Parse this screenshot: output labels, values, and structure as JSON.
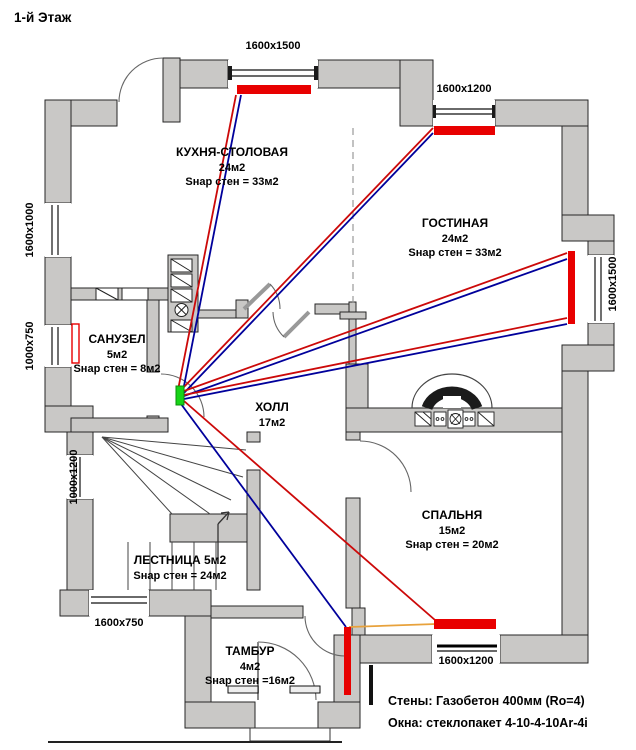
{
  "title": "1-й Этаж",
  "notes": {
    "walls": "Стены: Газобетон 400мм (Ro=4)",
    "windows": "Окна: стеклопакет 4-10-4-10Ar-4i"
  },
  "colors": {
    "wall_fill": "#c9c8c6",
    "wall_stroke": "#262626",
    "radiator": "#e80000",
    "pipe_supply": "#cc0909",
    "pipe_return": "#00009b",
    "pipe_link": "#e8a23c",
    "collector": "#17d417"
  },
  "rooms": [
    {
      "id": "kitchen",
      "cx": 232,
      "top": 145,
      "lines": [
        "КУХНЯ-СТОЛОВАЯ",
        "24м2",
        "Sнар стен = 33м2"
      ]
    },
    {
      "id": "living",
      "cx": 455,
      "top": 216,
      "lines": [
        "ГОСТИНАЯ",
        "24м2",
        "Sнар стен = 33м2"
      ]
    },
    {
      "id": "bathroom",
      "cx": 117,
      "top": 332,
      "lines": [
        "САНУЗЕЛ",
        "5м2",
        "Sнар стен = 8м2"
      ]
    },
    {
      "id": "hall",
      "cx": 272,
      "top": 400,
      "lines": [
        "ХОЛЛ",
        "17м2"
      ]
    },
    {
      "id": "bedroom",
      "cx": 452,
      "top": 508,
      "lines": [
        "СПАЛЬНЯ",
        "15м2",
        "Sнар стен = 20м2"
      ]
    },
    {
      "id": "stairs",
      "cx": 180,
      "top": 553,
      "lines": [
        "ЛЕСТНИЦА 5м2",
        "Sнар стен = 24м2"
      ]
    },
    {
      "id": "tambur",
      "cx": 250,
      "top": 644,
      "lines": [
        "ТАМБУР",
        "4м2",
        "Sнар стен =16м2"
      ]
    }
  ],
  "window_labels": [
    {
      "label": "1600x1500",
      "x": 273,
      "y": 46,
      "rot": false
    },
    {
      "label": "1600x1200",
      "x": 464,
      "y": 89,
      "rot": false
    },
    {
      "label": "1600x1000",
      "x": 30,
      "y": 230,
      "rot": true
    },
    {
      "label": "1000x750",
      "x": 30,
      "y": 346,
      "rot": true
    },
    {
      "label": "1000x1200",
      "x": 74,
      "y": 477,
      "rot": true
    },
    {
      "label": "1600x750",
      "x": 119,
      "y": 623,
      "rot": false
    },
    {
      "label": "1600x1200",
      "x": 466,
      "y": 661,
      "rot": false
    },
    {
      "label": "1600x1500",
      "x": 613,
      "y": 284,
      "rot": true
    }
  ],
  "heating": {
    "collector": {
      "x": 176,
      "y": 386,
      "w": 8,
      "h": 19
    },
    "radiators": [
      {
        "x": 237,
        "y": 85,
        "w": 74,
        "h": 9,
        "style": "fill"
      },
      {
        "x": 434,
        "y": 126,
        "w": 61,
        "h": 9,
        "style": "fill"
      },
      {
        "x": 568,
        "y": 251,
        "w": 7,
        "h": 73,
        "style": "fill"
      },
      {
        "x": 434,
        "y": 619,
        "w": 62,
        "h": 10,
        "style": "fill"
      },
      {
        "x": 344,
        "y": 627,
        "w": 7,
        "h": 68,
        "style": "fill"
      },
      {
        "x": 72,
        "y": 324,
        "w": 7,
        "h": 39,
        "style": "outline"
      }
    ],
    "pipes": [
      {
        "x1": 178,
        "y1": 390,
        "x2": 236,
        "y2": 95,
        "c": "supply"
      },
      {
        "x1": 183,
        "y1": 391,
        "x2": 241,
        "y2": 95,
        "c": "return"
      },
      {
        "x1": 182,
        "y1": 389,
        "x2": 433,
        "y2": 128,
        "c": "supply"
      },
      {
        "x1": 183,
        "y1": 394,
        "x2": 433,
        "y2": 133,
        "c": "return"
      },
      {
        "x1": 184,
        "y1": 391,
        "x2": 567,
        "y2": 253,
        "c": "supply"
      },
      {
        "x1": 184,
        "y1": 396,
        "x2": 567,
        "y2": 259,
        "c": "return"
      },
      {
        "x1": 184,
        "y1": 395,
        "x2": 567,
        "y2": 318,
        "c": "supply"
      },
      {
        "x1": 184,
        "y1": 399,
        "x2": 567,
        "y2": 324,
        "c": "return"
      },
      {
        "x1": 184,
        "y1": 401,
        "x2": 435,
        "y2": 620,
        "c": "supply"
      },
      {
        "x1": 181,
        "y1": 404,
        "x2": 346,
        "y2": 627,
        "c": "return"
      },
      {
        "x1": 349,
        "y1": 627,
        "x2": 436,
        "y2": 624,
        "c": "link"
      }
    ]
  }
}
